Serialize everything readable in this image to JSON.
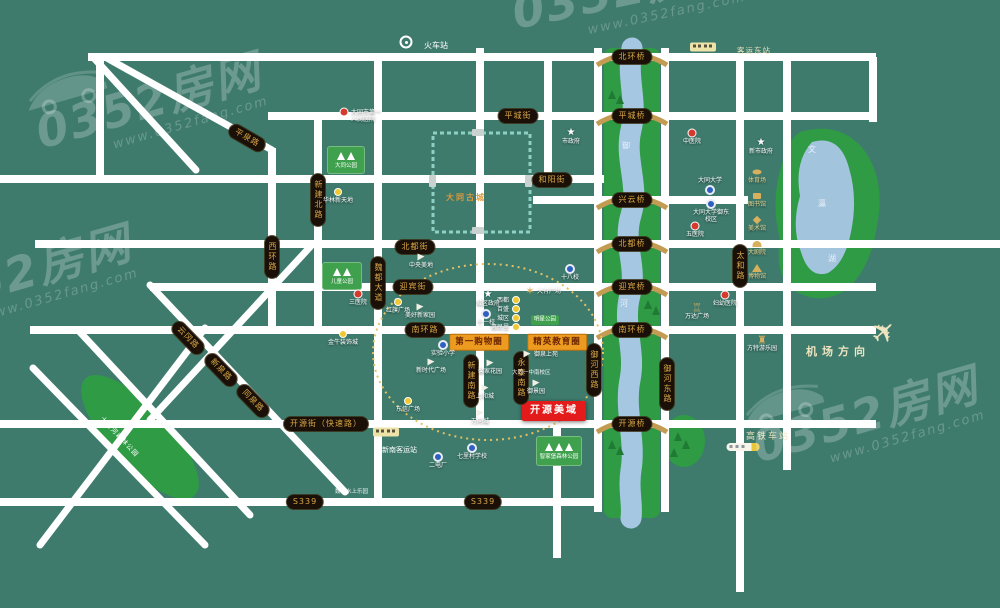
{
  "canvas": {
    "w": 1000,
    "h": 608
  },
  "colors": {
    "bg": "#3E7B6D",
    "road": "#ffffff",
    "greenway": "#2F9B45",
    "water": "#A6C7E2",
    "lake": "#A2C4DD",
    "pill_bg": "#1A1007",
    "pill_text": "#D9A747",
    "zone_bg": "#EC9A20",
    "project_bg": "#E31B1B",
    "sign_green": "#3FA04D",
    "gold": "#D8B05E",
    "cream": "#EFE4BF",
    "wall": "#8FD0C4",
    "old_city_text": "#E09A3C",
    "dash_circle": "#E3C063",
    "tree_dark": "#1F7A33"
  },
  "watermark": {
    "brand": "0352房网",
    "url": "www.0352fang.com",
    "instances": [
      {
        "x": 35,
        "y": 78,
        "rot": -16,
        "car": 1
      },
      {
        "x": -95,
        "y": 250,
        "rot": -16,
        "car": 0
      },
      {
        "x": 512,
        "y": -34,
        "rot": -12,
        "car": 0
      },
      {
        "x": 752,
        "y": 392,
        "rot": -16,
        "car": 1
      }
    ]
  },
  "project": {
    "label": "开源美域",
    "x": 554,
    "y": 411
  },
  "old_city": {
    "label": "大同古城",
    "x": 433,
    "y": 133,
    "w": 97,
    "h": 99,
    "label_x": 446,
    "label_y": 196
  },
  "zones": [
    {
      "label": "第一购物圈",
      "x": 479,
      "y": 342
    },
    {
      "label": "精英教育圈",
      "x": 557,
      "y": 342
    }
  ],
  "river_labels": [
    {
      "ch": "御",
      "x": 622,
      "y": 142
    },
    {
      "ch": "河",
      "x": 620,
      "y": 300
    }
  ],
  "lake_labels": [
    {
      "ch": "文",
      "x": 808,
      "y": 146
    },
    {
      "ch": "瀛",
      "x": 818,
      "y": 200
    },
    {
      "ch": "湖",
      "x": 828,
      "y": 255
    }
  ],
  "roads": {
    "h": [
      [
        88,
        876,
        57
      ],
      [
        268,
        876,
        116
      ],
      [
        0,
        604,
        179
      ],
      [
        533,
        748,
        200
      ],
      [
        35,
        1000,
        244
      ],
      [
        150,
        876,
        287
      ],
      [
        30,
        876,
        330
      ],
      [
        0,
        876,
        424
      ],
      [
        0,
        600,
        502
      ]
    ],
    "v": [
      [
        100,
        57,
        183
      ],
      [
        272,
        148,
        334
      ],
      [
        318,
        116,
        334
      ],
      [
        378,
        57,
        506
      ],
      [
        480,
        48,
        428
      ],
      [
        548,
        57,
        183
      ],
      [
        598,
        48,
        512
      ],
      [
        665,
        48,
        512
      ],
      [
        740,
        57,
        592
      ],
      [
        787,
        57,
        470
      ],
      [
        873,
        57,
        122
      ],
      [
        557,
        424,
        558
      ]
    ],
    "d": [
      [
        105,
        57,
        272,
        150
      ],
      [
        93,
        57,
        196,
        170
      ],
      [
        150,
        285,
        345,
        492
      ],
      [
        78,
        330,
        250,
        515
      ],
      [
        33,
        368,
        205,
        545
      ],
      [
        205,
        328,
        40,
        545
      ],
      [
        310,
        247,
        150,
        420
      ]
    ]
  },
  "pills": [
    {
      "label": "平城街",
      "x": 518,
      "y": 116,
      "rot": 0
    },
    {
      "label": "和阳街",
      "x": 552,
      "y": 180,
      "rot": 0
    },
    {
      "label": "北都街",
      "x": 415,
      "y": 247,
      "rot": 0
    },
    {
      "label": "迎宾街",
      "x": 413,
      "y": 287,
      "rot": 0
    },
    {
      "label": "南环路",
      "x": 425,
      "y": 330,
      "rot": 0
    },
    {
      "label": "开源街（快速路）",
      "x": 326,
      "y": 424,
      "rot": 0
    },
    {
      "label": "S339",
      "x": 305,
      "y": 502,
      "rot": 0
    },
    {
      "label": "S339",
      "x": 483,
      "y": 502,
      "rot": 0
    },
    {
      "label": "魏都大道",
      "x": 378,
      "y": 283,
      "rot": 90
    },
    {
      "label": "西环路",
      "x": 272,
      "y": 257,
      "rot": 90
    },
    {
      "label": "新建北路",
      "x": 318,
      "y": 200,
      "rot": 90
    },
    {
      "label": "新建南路",
      "x": 471,
      "y": 381,
      "rot": 90
    },
    {
      "label": "永泰南路",
      "x": 521,
      "y": 378,
      "rot": 90
    },
    {
      "label": "御河西路",
      "x": 594,
      "y": 370,
      "rot": 90
    },
    {
      "label": "御河东路",
      "x": 667,
      "y": 384,
      "rot": 90
    },
    {
      "label": "太和路",
      "x": 740,
      "y": 266,
      "rot": 90
    },
    {
      "label": "平泉路",
      "x": 247,
      "y": 138,
      "rot": 30
    },
    {
      "label": "云冈路",
      "x": 188,
      "y": 338,
      "rot": 46
    },
    {
      "label": "新泉路",
      "x": 221,
      "y": 370,
      "rot": 46
    },
    {
      "label": "同泉路",
      "x": 253,
      "y": 401,
      "rot": 46
    }
  ],
  "bridges": [
    {
      "label": "北环桥",
      "y": 57
    },
    {
      "label": "平城桥",
      "y": 116
    },
    {
      "label": "兴云桥",
      "y": 200
    },
    {
      "label": "北都桥",
      "y": 244
    },
    {
      "label": "迎宾桥",
      "y": 287
    },
    {
      "label": "南环桥",
      "y": 330
    },
    {
      "label": "开源桥",
      "y": 424
    }
  ],
  "parks": [
    {
      "label": "大同公园",
      "x": 327,
      "y": 146,
      "w": 38,
      "h": 28,
      "trees": 2
    },
    {
      "label": "儿童公园",
      "x": 322,
      "y": 262,
      "w": 40,
      "h": 28,
      "trees": 2
    },
    {
      "label": "智家堡森林公园",
      "x": 536,
      "y": 436,
      "w": 46,
      "h": 30,
      "trees": 3
    }
  ],
  "forest_park": {
    "label": "十里河森林公园",
    "cx": 140,
    "cy": 437,
    "rx": 80,
    "ry": 30,
    "rot": 47
  },
  "civic": {
    "x": 757,
    "y0": 172,
    "step": 24,
    "items": [
      {
        "label": "体育场"
      },
      {
        "label": "图书馆"
      },
      {
        "label": "美术馆"
      },
      {
        "label": "大剧院"
      },
      {
        "label": "博物馆"
      }
    ]
  },
  "pois": [
    {
      "t": "star",
      "x": 488,
      "y": 295,
      "label": "城区政府"
    },
    {
      "t": "star",
      "x": 761,
      "y": 143,
      "label": "新市政府"
    },
    {
      "t": "star",
      "x": 571,
      "y": 133,
      "label": "市政府"
    },
    {
      "t": "hosp",
      "x": 358,
      "y": 294,
      "label": "三医院"
    },
    {
      "t": "hosp",
      "x": 692,
      "y": 133,
      "label": "中医院"
    },
    {
      "t": "hosp",
      "x": 695,
      "y": 226,
      "label": "五医院"
    },
    {
      "t": "hosp",
      "x": 725,
      "y": 295,
      "label": "妇幼医院"
    },
    {
      "t": "hosp",
      "x": 344,
      "y": 112,
      "label": "大同市第一人民医院",
      "lp": "right",
      "w": 34
    },
    {
      "t": "school",
      "x": 710,
      "y": 190,
      "label": "大同大学",
      "lp": "above"
    },
    {
      "t": "school",
      "x": 711,
      "y": 204,
      "label": "大同大学御东校区",
      "w": 38
    },
    {
      "t": "school",
      "x": 570,
      "y": 269,
      "label": "十八校"
    },
    {
      "t": "school",
      "x": 486,
      "y": 314,
      "label": "十一校"
    },
    {
      "t": "school",
      "x": 443,
      "y": 345,
      "label": "实验小学"
    },
    {
      "t": "school",
      "x": 472,
      "y": 448,
      "label": "七里村学校"
    },
    {
      "t": "school",
      "x": 438,
      "y": 457,
      "label": "二电厂"
    },
    {
      "t": "mall",
      "x": 338,
      "y": 192,
      "label": "华林新天地"
    },
    {
      "t": "mall",
      "x": 398,
      "y": 302,
      "label": "红旗广场"
    },
    {
      "t": "mall",
      "x": 343,
      "y": 334,
      "label": "金牛装饰城"
    },
    {
      "t": "mall",
      "x": 408,
      "y": 401,
      "label": "东信广场"
    },
    {
      "t": "mall",
      "x": 516,
      "y": 300,
      "label": "西都",
      "lp": "left"
    },
    {
      "t": "mall",
      "x": 516,
      "y": 309,
      "label": "百盛",
      "lp": "left"
    },
    {
      "t": "mall",
      "x": 516,
      "y": 318,
      "label": "城区",
      "lp": "left"
    },
    {
      "t": "mall",
      "x": 516,
      "y": 327,
      "label": "惠民里",
      "lp": "left"
    },
    {
      "t": "flag",
      "x": 421,
      "y": 257,
      "label": "中央美地"
    },
    {
      "t": "flag",
      "x": 420,
      "y": 307,
      "label": "美好新家园"
    },
    {
      "t": "flag",
      "x": 431,
      "y": 362,
      "label": "新时代广场"
    },
    {
      "t": "flag",
      "x": 490,
      "y": 363,
      "label": "馨家花园"
    },
    {
      "t": "flag",
      "x": 485,
      "y": 388,
      "label": "上和城"
    },
    {
      "t": "flag",
      "x": 480,
      "y": 413,
      "label": "万向城"
    },
    {
      "t": "flag",
      "x": 527,
      "y": 354,
      "label": "御泉上苑",
      "lp": "right"
    },
    {
      "t": "flag",
      "x": 536,
      "y": 383,
      "label": "御景园"
    },
    {
      "t": "gold",
      "x": 530,
      "y": 291,
      "label": "大有广场",
      "lp": "right",
      "g": "✶"
    },
    {
      "t": "gold",
      "x": 762,
      "y": 340,
      "label": "方特游乐园",
      "g": "♜"
    },
    {
      "t": "gold",
      "x": 697,
      "y": 308,
      "label": "万达广场",
      "g": "♖"
    },
    {
      "t": "greenpill",
      "x": 545,
      "y": 320,
      "label": "明星公园"
    }
  ],
  "texts": [
    {
      "label": "机场方向",
      "x": 806,
      "y": 346,
      "cls": "airport"
    },
    {
      "label": "高铁车站",
      "x": 746,
      "y": 433,
      "cls": "cream-md"
    },
    {
      "label": "客运东站",
      "x": 737,
      "y": 47,
      "cls": "cream-sm"
    },
    {
      "label": "火车站",
      "x": 424,
      "y": 42,
      "cls": "white-md"
    },
    {
      "label": "新南客运站",
      "x": 382,
      "y": 447,
      "cls": "white-sm"
    },
    {
      "label": "魏都水上乐园",
      "x": 335,
      "y": 490,
      "cls": "white-xs"
    },
    {
      "label": "大同一中南校区",
      "x": 512,
      "y": 371,
      "cls": "white-xs"
    },
    {
      "label": "大同古城",
      "x": 446,
      "y": 194,
      "cls": "oldcity"
    }
  ],
  "icons": [
    {
      "type": "bus",
      "x": 703,
      "y": 47
    },
    {
      "type": "bus",
      "x": 386,
      "y": 432
    },
    {
      "type": "train",
      "x": 743,
      "y": 447
    },
    {
      "type": "plane",
      "x": 872,
      "y": 318
    },
    {
      "type": "rail",
      "x": 406,
      "y": 42
    }
  ],
  "dash_circle": {
    "cx": 488,
    "cy": 352,
    "rx": 115,
    "ry": 88
  }
}
